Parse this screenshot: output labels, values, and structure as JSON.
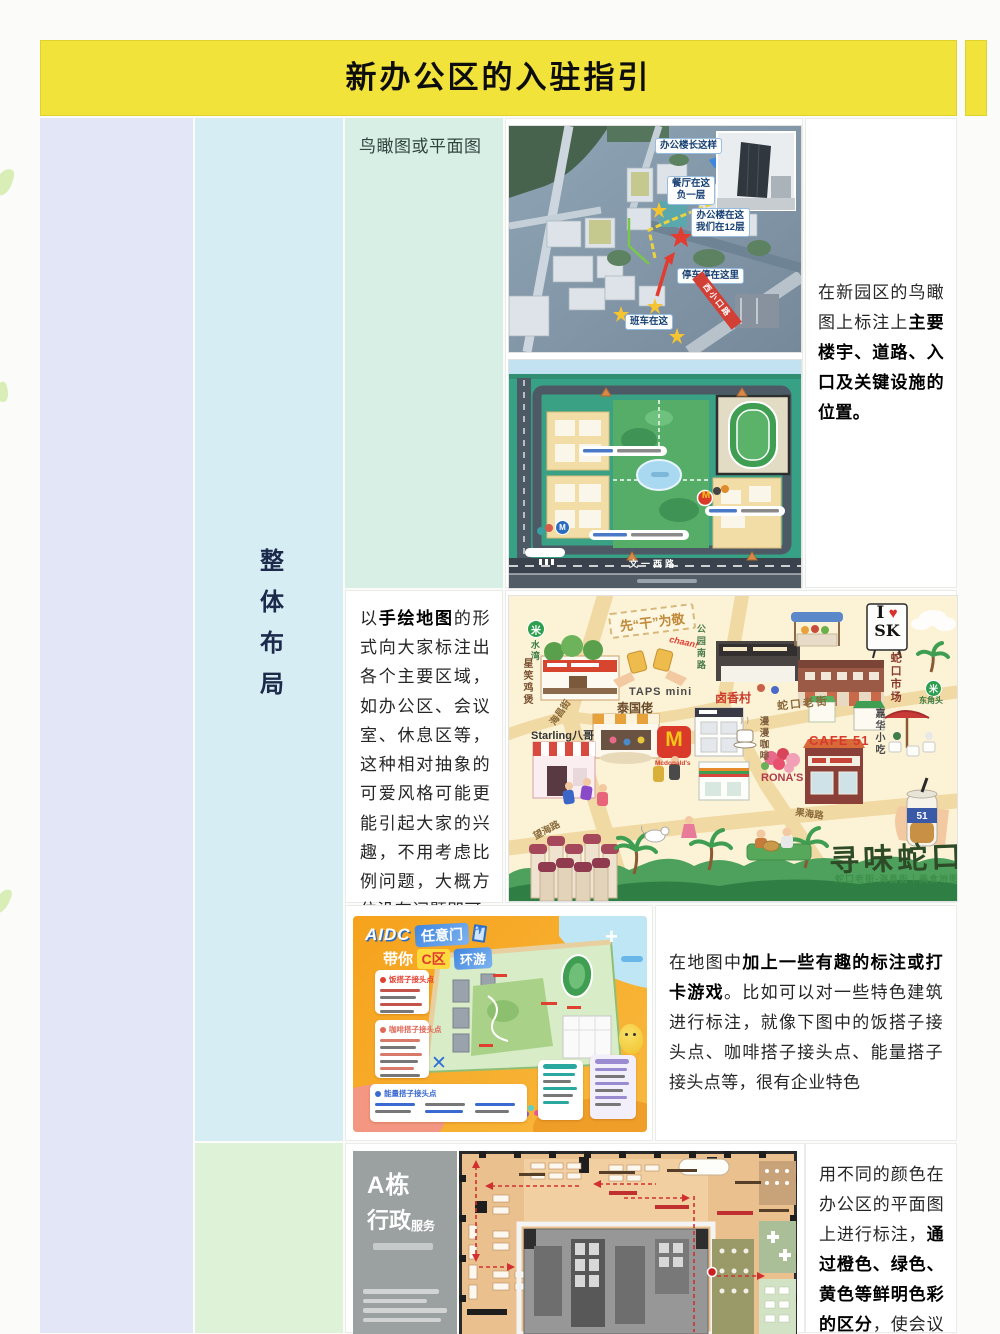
{
  "window": {
    "title": "新办公区的入驻指引"
  },
  "table": {
    "section_label": "整体布局",
    "rows": {
      "r1": {
        "left_label": "鸟瞰图或平面图",
        "right": {
          "pre": "在新园区的鸟瞰图上标注上",
          "bold": "主要楼宇、道路、入口及关键设施的位置。"
        }
      },
      "r2": {
        "left": {
          "pre": "以",
          "bold": "手绘地图",
          "post": "的形式向大家标注出各个主要区域，如办公区、会议室、休息区等，这种相对抽象的可爱风格可能更能引起大家的兴趣，不用考虑比例问题，大概方位没有问题即可"
        }
      },
      "r3": {
        "right": {
          "pre": "在地图中",
          "bold": "加上一些有趣的标注或打卡游戏",
          "post": "。比如可以对一些特色建筑进行标注，就像下图中的饭搭子接头点、咖啡搭子接头点、能量搭子接头点等，很有企业特色"
        }
      },
      "r4": {
        "right": {
          "pre": "用不同的颜色在办公区的平面图上进行标注，",
          "bold": "通过橙色、绿色、黄色等鲜明色彩的区分",
          "post": "，使会议室、接待室、办"
        }
      }
    }
  },
  "aerial": {
    "callout_building": "办公楼长这样",
    "callout_canteen_1": "餐厅在这",
    "callout_canteen_2": "负一层",
    "callout_office_1": "办公楼在这",
    "callout_office_2": "我们在12层",
    "callout_parking": "停车停在这里",
    "callout_shuttle": "班车在这",
    "road_label": "西小口路"
  },
  "campus_map": {
    "road_label": "文一西路",
    "metro_letter": "M",
    "mcd_letter": "M"
  },
  "hand_map": {
    "metro_glyph": "米",
    "metro_left_station": "水湾",
    "metro_right_station": "东角头",
    "shop_chicken": "星笑鸡煲",
    "cheers_banner": "先“干”为敬",
    "cheers_sfx": "chaan!",
    "shop_taps": "TAPS mini",
    "road_gongyuan": "公园南路",
    "shop_luxiang": "卤香村",
    "market": "蛇口市场",
    "shop_jiahua": "嘉华小吃",
    "sign_i": "I",
    "sign_heart": "♥",
    "sign_sk": "SK",
    "shop_thai": "泰国佬",
    "shop_starling": "Starling八哥",
    "mcd_letter": "M",
    "mcd_name": "Mcdonald's",
    "road_shekou": "蛇口老街",
    "shop_coffee": "漫漫咖啡",
    "shop_cafe51": "CAFE 51",
    "shop_ronas": "RONA'S",
    "road_haichang": "海昌街",
    "road_wanghai": "望海路",
    "road_guohai": "果海路",
    "cup_label": "51",
    "title": "寻味蛇口",
    "subtitle": "蛇口老街-海昌街｜美食地图"
  },
  "poster": {
    "brand": "AIDC",
    "door_badge": "任意门",
    "line2_pre": "带你",
    "zone_badge": "C区",
    "line2_post": "环游",
    "legend_meal": "饭搭子接头点",
    "legend_coffee": "咖啡搭子接头点",
    "legend_energy": "能量搭子接头点",
    "x_marker": "✕",
    "compass": "+",
    "plane": "✈"
  },
  "floor_plan": {
    "building": "A栋",
    "dept_big": "行政",
    "dept_small": "服务"
  },
  "colors": {
    "header_yellow": "#f2e33b",
    "col_lavender": "#e3e6f7",
    "col_cyan": "#d6edf3",
    "cell_mint": "#d8efe5",
    "cell_green": "#ddf2d6"
  }
}
